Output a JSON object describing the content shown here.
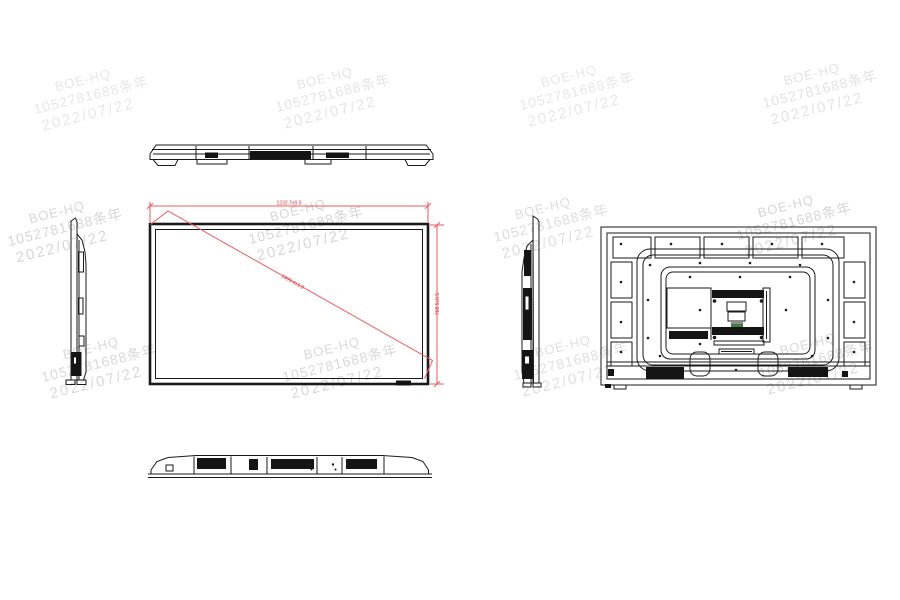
{
  "drawing": {
    "type": "engineering-outline-drawing",
    "subject": "flat-panel-display",
    "line_color": "#1a1a1a",
    "background": "#ffffff"
  },
  "watermark": {
    "lines": [
      "BOE-HQ",
      "1052781688条年",
      "2022/07/22"
    ],
    "color": "#cfcfcf",
    "rotation_deg": -14,
    "tiles": [
      {
        "x": 28,
        "y": 86,
        "o": 0.5
      },
      {
        "x": 270,
        "y": 84,
        "o": 0.55
      },
      {
        "x": 514,
        "y": 82,
        "o": 0.5
      },
      {
        "x": 757,
        "y": 80,
        "o": 0.6
      },
      {
        "x": 2,
        "y": 218,
        "o": 0.85
      },
      {
        "x": 243,
        "y": 216,
        "o": 0.85
      },
      {
        "x": 488,
        "y": 214,
        "o": 0.7
      },
      {
        "x": 731,
        "y": 212,
        "o": 0.85
      },
      {
        "x": 36,
        "y": 354,
        "o": 0.8
      },
      {
        "x": 277,
        "y": 354,
        "o": 0.8
      },
      {
        "x": 508,
        "y": 352,
        "o": 0.65
      },
      {
        "x": 753,
        "y": 350,
        "o": 0.8
      }
    ]
  },
  "dimensions": {
    "line_color": "#ee5a5e",
    "text_color": "#cc2f34",
    "width_label": "1232.7±0.5",
    "height_label": "708.5±0.5",
    "diagonal_label": "1399.4±1.0"
  }
}
